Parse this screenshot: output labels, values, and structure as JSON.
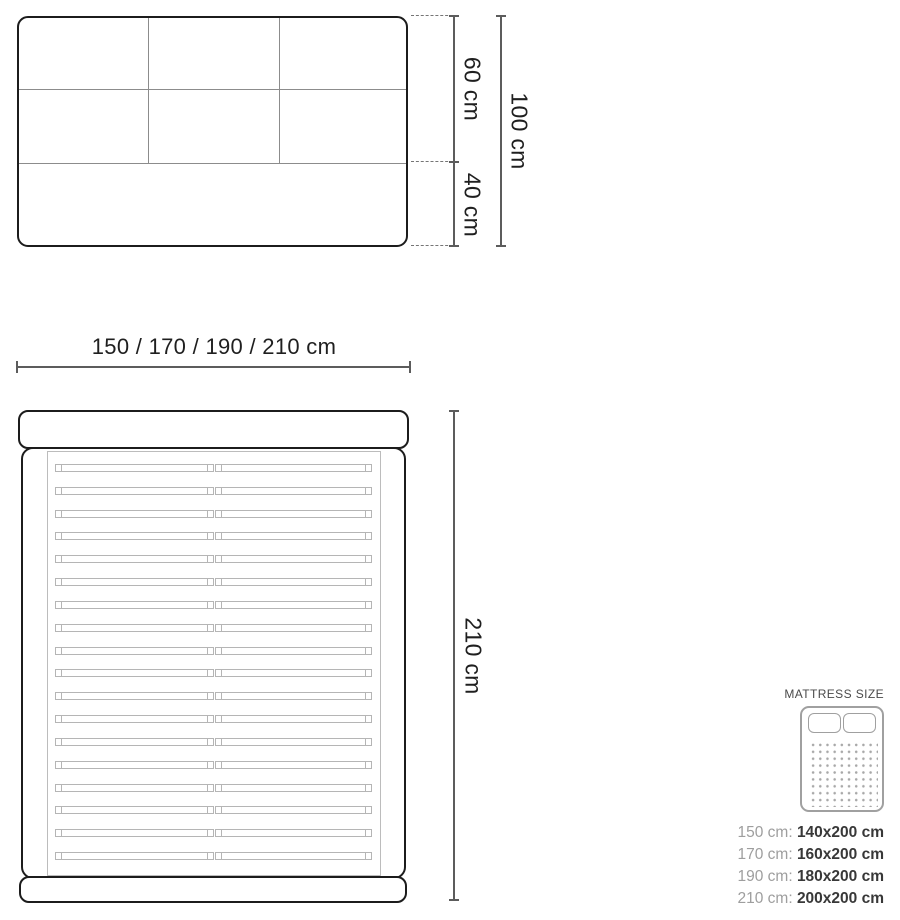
{
  "diagram": {
    "front_view": {
      "dim_upper": "60 cm",
      "dim_lower": "40 cm",
      "dim_total": "100 cm"
    },
    "top_view": {
      "dim_width": "150 / 170 / 190 / 210 cm",
      "dim_length": "210 cm",
      "slat_count": 18
    },
    "legend": {
      "title": "MATTRESS SIZE",
      "icon": "mattress-icon",
      "rows": [
        {
          "frame": "150 cm:",
          "mattress": "140x200 cm"
        },
        {
          "frame": "170 cm:",
          "mattress": "160x200 cm"
        },
        {
          "frame": "190 cm:",
          "mattress": "180x200 cm"
        },
        {
          "frame": "210 cm:",
          "mattress": "200x200 cm"
        }
      ]
    },
    "colors": {
      "outline": "#1c1c1c",
      "grid_line": "#8c8c8c",
      "slat_line": "#b5b5b5",
      "dimension_line": "#5c5c5c",
      "label_text": "#1f1f1f",
      "legend_title_text": "#4a4a4a",
      "legend_frame_text": "#9e9e9e",
      "legend_mattress_text": "#383838",
      "icon_stroke": "#a0a0a0"
    }
  }
}
